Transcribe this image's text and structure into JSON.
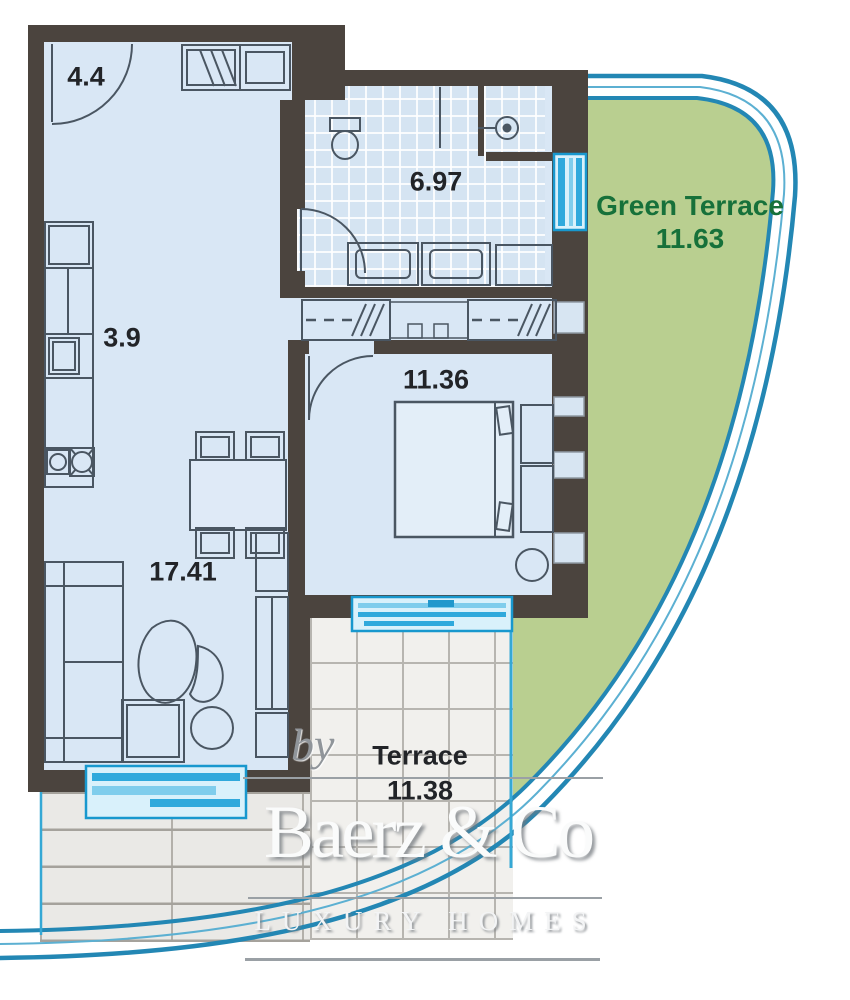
{
  "plan": {
    "rooms": [
      {
        "name": "entrance-hall",
        "area": "4.4"
      },
      {
        "name": "bathroom",
        "area": "6.97"
      },
      {
        "name": "kitchen",
        "area": "3.9"
      },
      {
        "name": "bedroom",
        "area": "11.36"
      },
      {
        "name": "living-room",
        "area": "17.41"
      }
    ],
    "green_terrace": {
      "label": "Green Terrace",
      "area": "11.63"
    },
    "terrace": {
      "label": "Terrace",
      "area": "11.38"
    }
  },
  "branding": {
    "prefix": "by",
    "company": "Baerz & Co",
    "tagline": "LUXURY HOMES"
  },
  "colors": {
    "wall": "#4b443e",
    "floor": "#d9e7f5",
    "bathroom_tile": "#d5e4f2",
    "green_terrace_fill": "#b9cf90",
    "green_text": "#17713a",
    "window_frame_cyan": "#1898ce",
    "window_fill_cyan": "#d9f1fb",
    "railing_blue": "#2387b4",
    "label_text": "#222428",
    "terrace_tile": "#f1f0ed",
    "outdoor_tile": "#eae9e6"
  }
}
